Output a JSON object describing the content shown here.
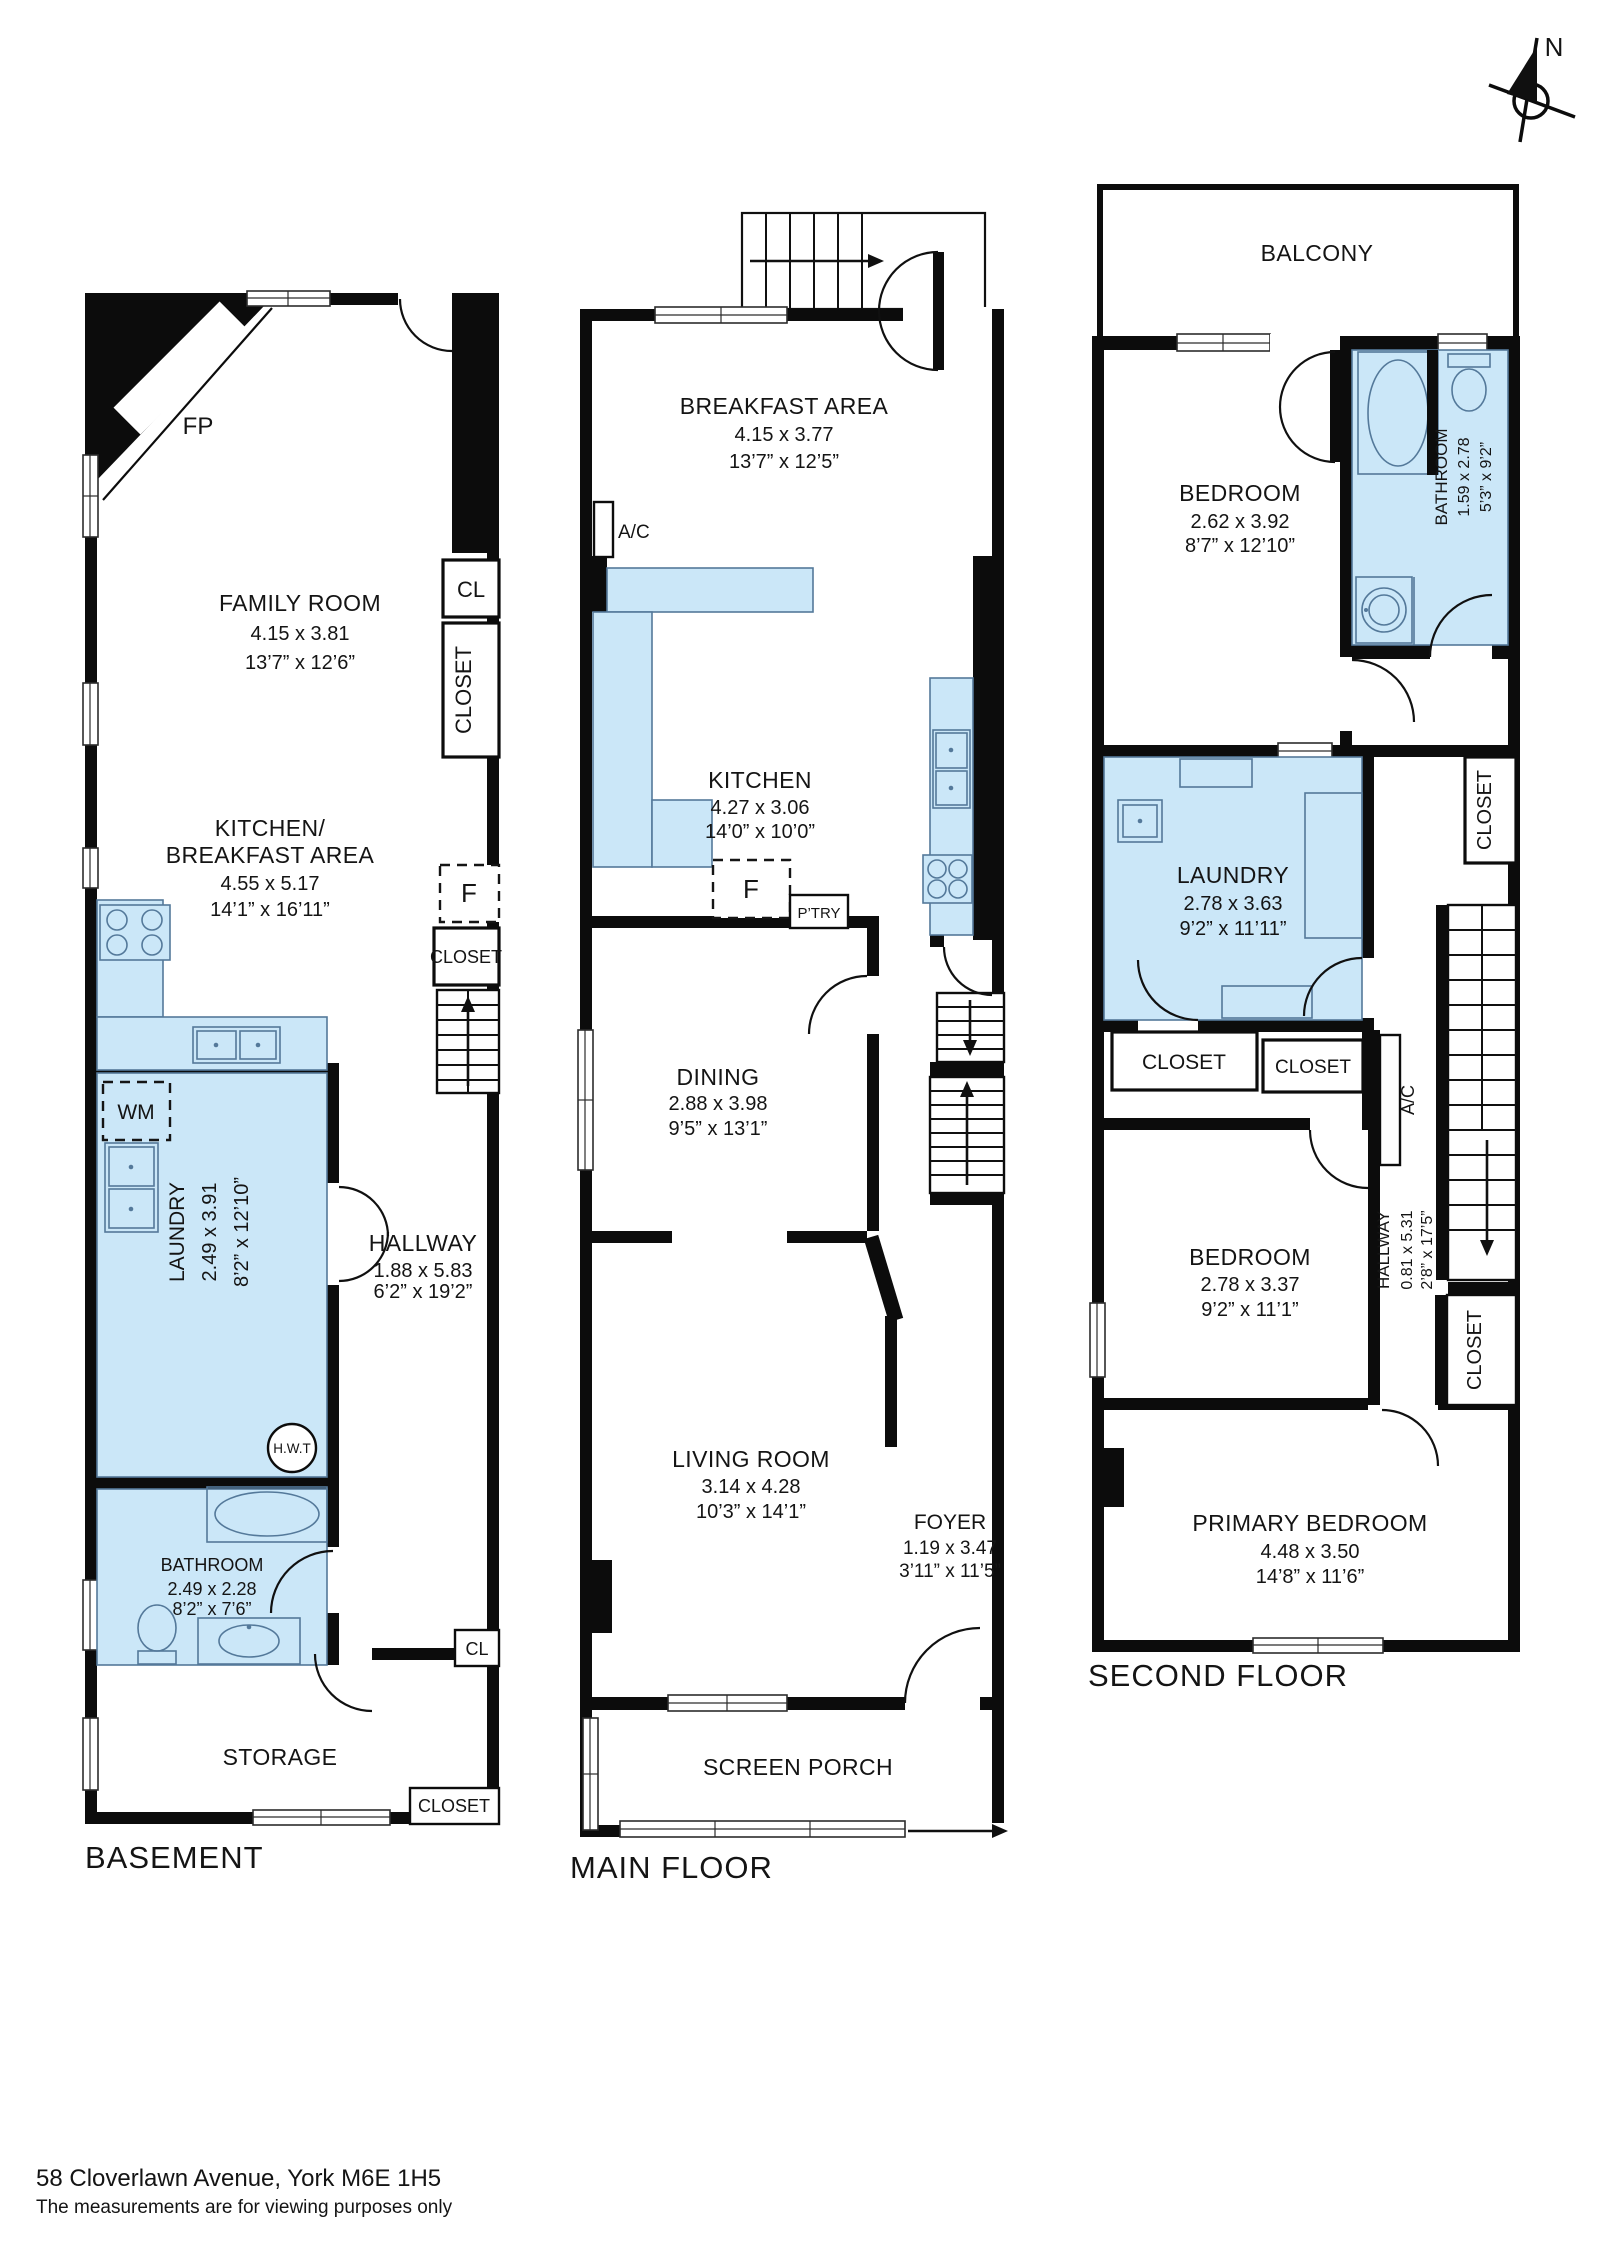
{
  "address": {
    "line1": "58 Cloverlawn Avenue, York M6E 1H5",
    "line2": "The measurements are for viewing purposes only"
  },
  "compass": {
    "north": "N"
  },
  "colors": {
    "wall": "#0c0c0c",
    "wet_fill": "#CBE7F8",
    "wet_stroke": "#54799A"
  },
  "basement": {
    "title": "BASEMENT",
    "fireplace": "FP",
    "family_room": {
      "name": "FAMILY ROOM",
      "metric": "4.15 x 3.81",
      "imperial": "13’7” x 12’6”"
    },
    "closet_cl_top": "CL",
    "closet_tall": "CLOSET",
    "fridge": "F",
    "closet_mid": "CLOSET",
    "kitchen": {
      "name_line1": "KITCHEN/",
      "name_line2": "BREAKFAST AREA",
      "metric": "4.55 x 5.17",
      "imperial": "14’1” x 16’11”"
    },
    "washer": "WM",
    "laundry": {
      "name": "LAUNDRY",
      "metric": "2.49 x 3.91",
      "imperial": "8’2” x 12’10”"
    },
    "water_tank": "H.W.T",
    "hallway": {
      "name": "HALLWAY",
      "metric": "1.88 x 5.83",
      "imperial": "6’2” x 19’2”"
    },
    "bathroom": {
      "name": "BATHROOM",
      "metric": "2.49 x 2.28",
      "imperial": "8’2” x 7’6”"
    },
    "storage": {
      "name": "STORAGE"
    },
    "closet_cl_bottom": "CL",
    "closet_bottom": "CLOSET"
  },
  "main_floor": {
    "title": "MAIN FLOOR",
    "breakfast": {
      "name": "BREAKFAST AREA",
      "metric": "4.15 x 3.77",
      "imperial": "13’7” x 12’5”"
    },
    "ac": "A/C",
    "kitchen": {
      "name": "KITCHEN",
      "metric": "4.27 x 3.06",
      "imperial": "14’0” x 10’0”"
    },
    "fridge": "F",
    "pantry": "P’TRY",
    "dining": {
      "name": "DINING",
      "metric": "2.88 x 3.98",
      "imperial": "9’5” x 13’1”"
    },
    "living": {
      "name": "LIVING ROOM",
      "metric": "3.14 x 4.28",
      "imperial": "10’3” x 14’1”"
    },
    "foyer": {
      "name": "FOYER",
      "metric": "1.19 x 3.47",
      "imperial": "3’11” x 11’5”"
    },
    "porch": {
      "name": "SCREEN PORCH"
    }
  },
  "second_floor": {
    "title": "SECOND FLOOR",
    "balcony": {
      "name": "BALCONY"
    },
    "bedroom_front": {
      "name": "BEDROOM",
      "metric": "2.62 x 3.92",
      "imperial": "8’7” x 12’10”"
    },
    "bathroom": {
      "name": "BATHROOM",
      "metric": "1.59 x 2.78",
      "imperial": "5’3” x 9’2”"
    },
    "closet_landing": "CLOSET",
    "laundry": {
      "name": "LAUNDRY",
      "metric": "2.78 x 3.63",
      "imperial": "9’2” x 11’11”"
    },
    "closet_left": "CLOSET",
    "closet_right": "CLOSET",
    "ac": "A/C",
    "hallway": {
      "name": "HALLWAY",
      "metric": "0.81 x 5.31",
      "imperial": "2’8” x 17’5”"
    },
    "bedroom_middle": {
      "name": "BEDROOM",
      "metric": "2.78 x 3.37",
      "imperial": "9’2” x 11’1”"
    },
    "closet_hall": "CLOSET",
    "primary_bedroom": {
      "name": "PRIMARY BEDROOM",
      "metric": "4.48 x 3.50",
      "imperial": "14’8” x 11’6”"
    }
  }
}
